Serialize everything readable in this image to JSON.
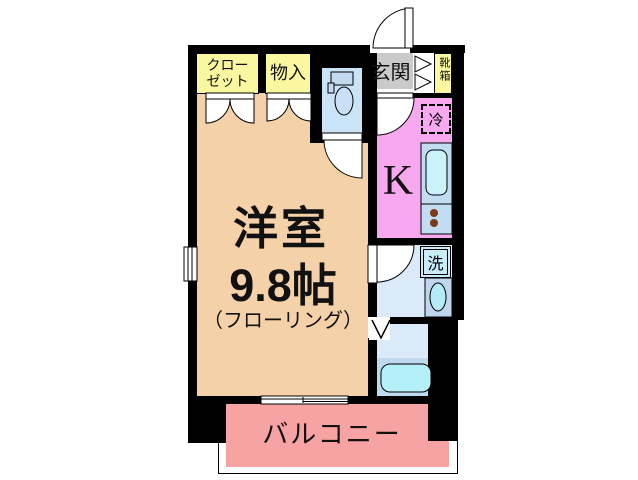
{
  "floorplan": {
    "main_room": {
      "name": "洋室",
      "size": "9.8帖",
      "floor_note": "（フローリング）"
    },
    "kitchen": {
      "label": "K"
    },
    "balcony": {
      "label": "バルコニー"
    },
    "entrance": {
      "label": "玄関"
    },
    "closet": {
      "line1": "クロー",
      "line2": "ゼット"
    },
    "storage": {
      "label": "物入"
    },
    "shoe_box": {
      "label": "靴箱"
    },
    "refrigerator": {
      "label": "冷"
    },
    "washer": {
      "label": "洗"
    },
    "colors": {
      "wall": "#000000",
      "main_room": "#F4D1A9",
      "kitchen": "#F8A8EF",
      "closet_yellow": "#FAF7A0",
      "entrance_gray": "#CACACA",
      "balcony_pink": "#F8A3A3",
      "wet_area_blue": "#DAEAF9",
      "toilet_blue": "#CAE3F6",
      "counter_blue": "#C2DCF2",
      "water_cyan": "#B5F0F9",
      "burner_brown": "#7D3B16"
    }
  }
}
